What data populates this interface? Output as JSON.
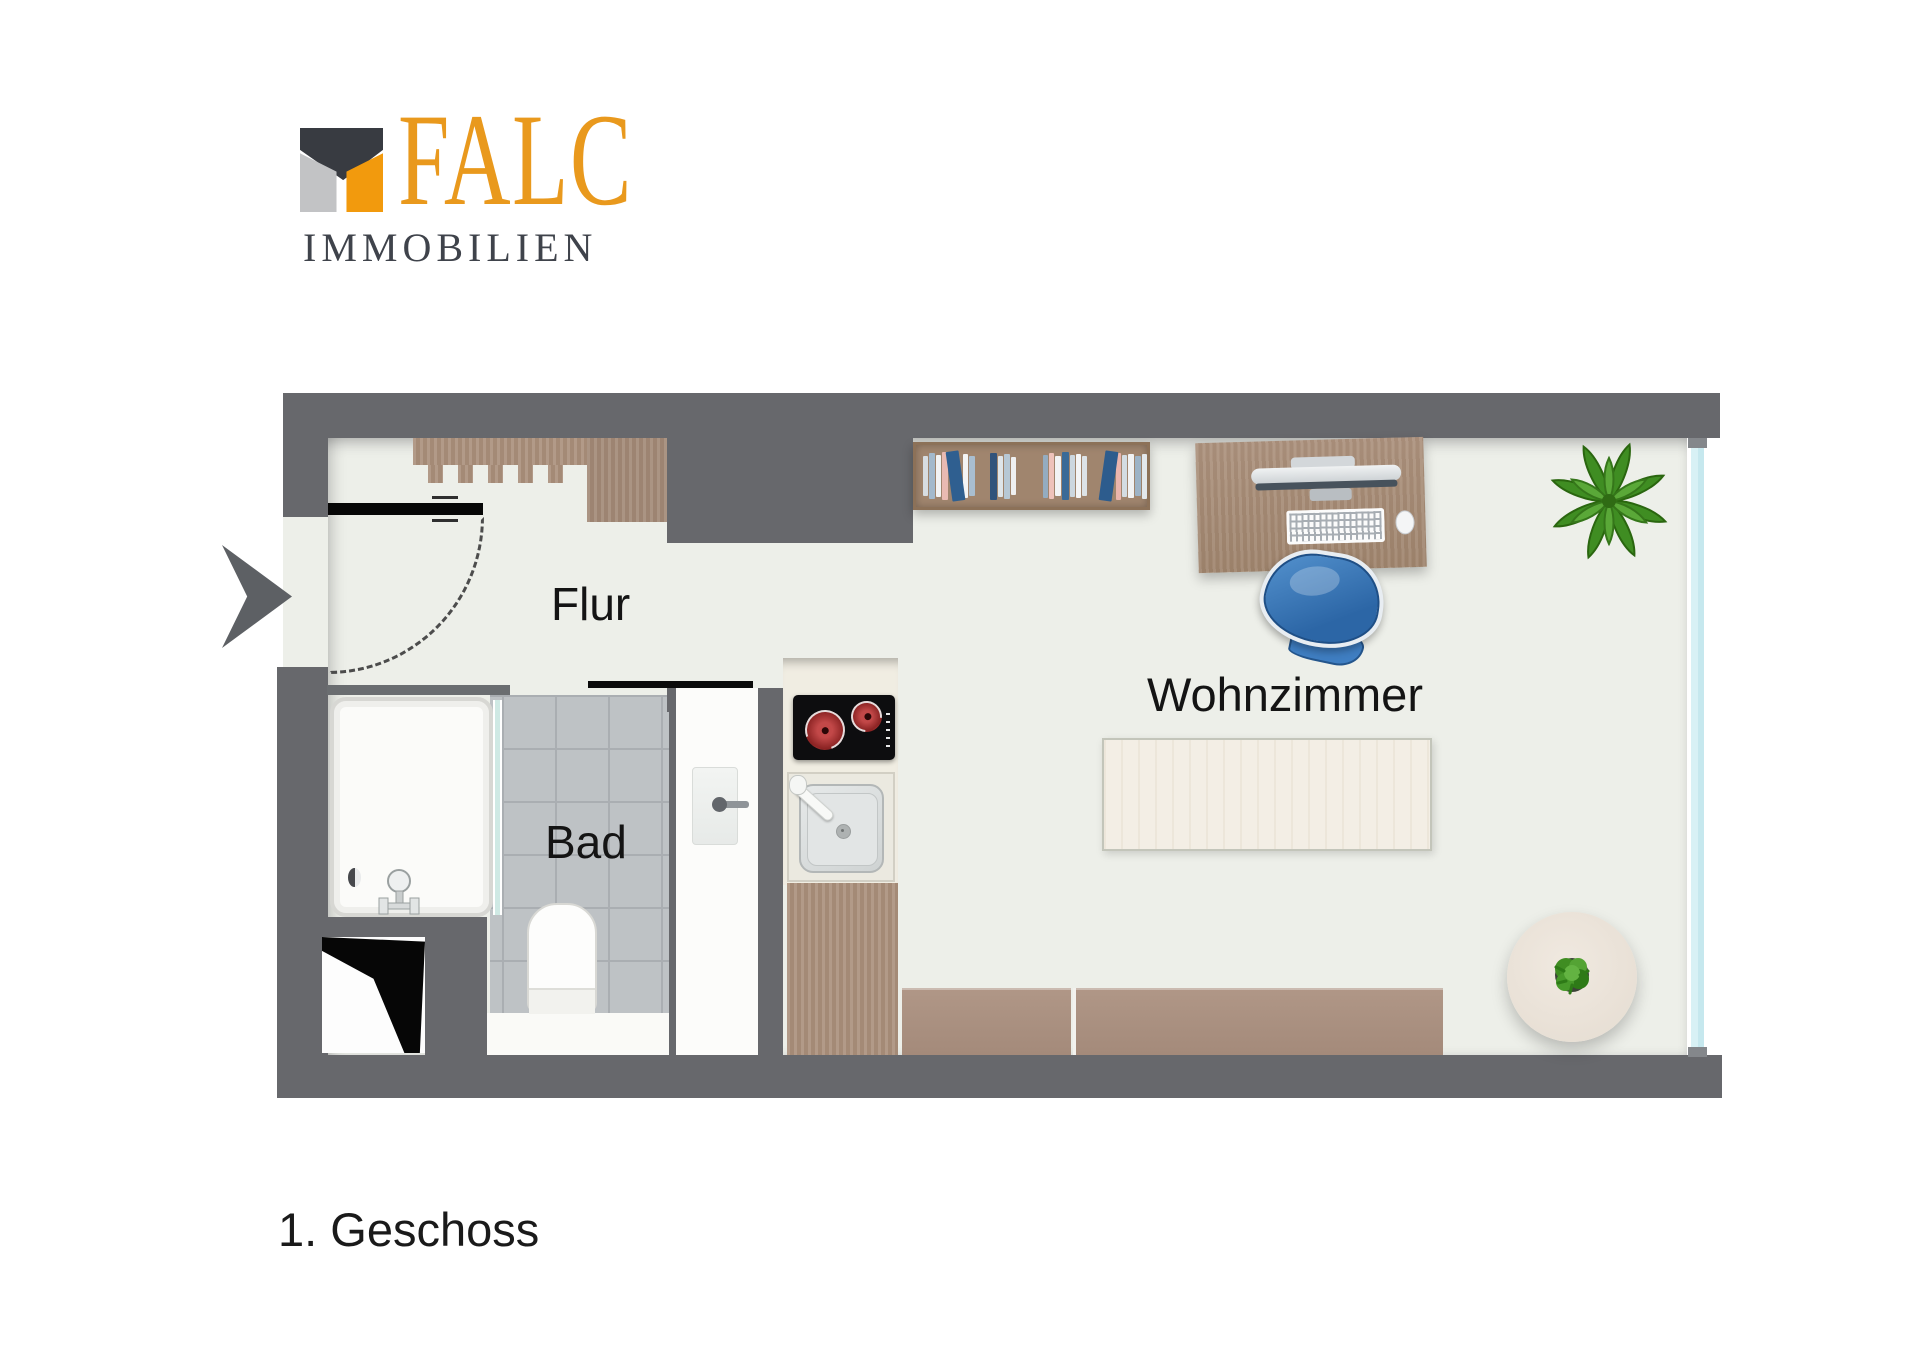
{
  "logo": {
    "brand": "FALC",
    "subtitle": "IMMOBILIEN"
  },
  "rooms": [
    {
      "id": "flur",
      "label": "Flur"
    },
    {
      "id": "bad",
      "label": "Bad"
    },
    {
      "id": "wohnzimmer",
      "label": "Wohnzimmer"
    }
  ],
  "floor_label": "1. Geschoss",
  "palette": {
    "brand-orange": "#e9991d",
    "brand-dark": "#3f434b",
    "icon-dark": "#383b41",
    "icon-gray": "#c2c3c5",
    "icon-orange": "#f29a0d",
    "wall": "#67686c",
    "floor": "#edefe9",
    "tile": "#bec2c5",
    "window": "#d8f1f5",
    "glass": "#cfe9e4",
    "counter": "#f0ede2",
    "wood": "#ab917e",
    "chair-blue": "#3f7ec2",
    "plant-green": "#3f8d22"
  },
  "furniture": {
    "bookshelf": {
      "books": [
        {
          "c": "#d7dde2",
          "w": 5,
          "h": 40
        },
        {
          "c": "#a3b9cc",
          "w": 6,
          "h": 46
        },
        {
          "c": "#f2f3f4",
          "w": 5,
          "h": 42
        },
        {
          "c": "#e9bab2",
          "w": 6,
          "h": 48
        },
        {
          "c": "#2f5f90",
          "w": 13,
          "h": 50,
          "r": -8
        },
        {
          "c": "#f3f4f5",
          "w": 5,
          "h": 44
        },
        {
          "c": "#a9bed0",
          "w": 6,
          "h": 40
        },
        {
          "c": "#31537b",
          "w": 7,
          "h": 47,
          "g": 14
        },
        {
          "c": "#dfe5e9",
          "w": 5,
          "h": 41
        },
        {
          "c": "#b7c8d5",
          "w": 6,
          "h": 45
        },
        {
          "c": "#eff0f1",
          "w": 5,
          "h": 38
        },
        {
          "c": "#94acc0",
          "w": 5,
          "h": 43,
          "g": 26
        },
        {
          "c": "#eec2ba",
          "w": 5,
          "h": 46
        },
        {
          "c": "#f2f3f4",
          "w": 6,
          "h": 40
        },
        {
          "c": "#3a6a97",
          "w": 7,
          "h": 48
        },
        {
          "c": "#ccd7df",
          "w": 5,
          "h": 42
        },
        {
          "c": "#f4f5f6",
          "w": 5,
          "h": 44
        },
        {
          "c": "#dde3e7",
          "w": 5,
          "h": 40
        },
        {
          "c": "#2d5c8d",
          "w": 13,
          "h": 50,
          "r": 8,
          "g": 14
        },
        {
          "c": "#eab5ad",
          "w": 5,
          "h": 47
        },
        {
          "c": "#d3dce2",
          "w": 5,
          "h": 42
        },
        {
          "c": "#f1f2f3",
          "w": 6,
          "h": 44
        },
        {
          "c": "#9db3c6",
          "w": 6,
          "h": 40
        },
        {
          "c": "#e3e8ec",
          "w": 5,
          "h": 45
        }
      ]
    }
  }
}
